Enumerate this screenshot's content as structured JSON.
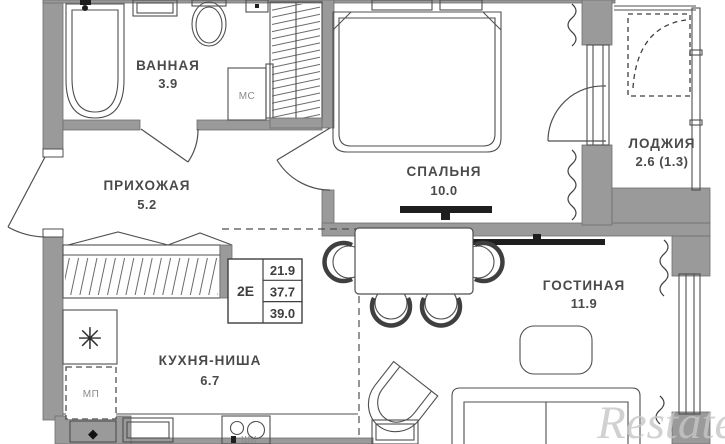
{
  "plan": {
    "rooms": [
      {
        "id": "bathroom",
        "label": "ВАННАЯ",
        "area": "3.9"
      },
      {
        "id": "hallway",
        "label": "ПРИХОЖАЯ",
        "area": "5.2"
      },
      {
        "id": "bedroom",
        "label": "СПАЛЬНЯ",
        "area": "10.0"
      },
      {
        "id": "loggia",
        "label": "ЛОДЖИЯ",
        "area": "2.6 (1.3)"
      },
      {
        "id": "living",
        "label": "ГОСТИНАЯ",
        "area": "11.9"
      },
      {
        "id": "kitchen",
        "label": "КУХНЯ-НИША",
        "area": "6.7"
      }
    ],
    "area_table": {
      "type_label": "2Е",
      "rows": [
        "21.9",
        "37.7",
        "39.0"
      ]
    },
    "tags": {
      "washing_machine": "МС",
      "appliance_slot": "МП",
      "cabinet": "ШК"
    },
    "icons": {
      "fridge": "✳",
      "vent": "◆"
    },
    "watermark": "Restate",
    "colors": {
      "wall": "#9a9a9a",
      "line": "#4f4f4f",
      "text": "#4a4a4a",
      "watermark": "#c6c6c6"
    }
  }
}
